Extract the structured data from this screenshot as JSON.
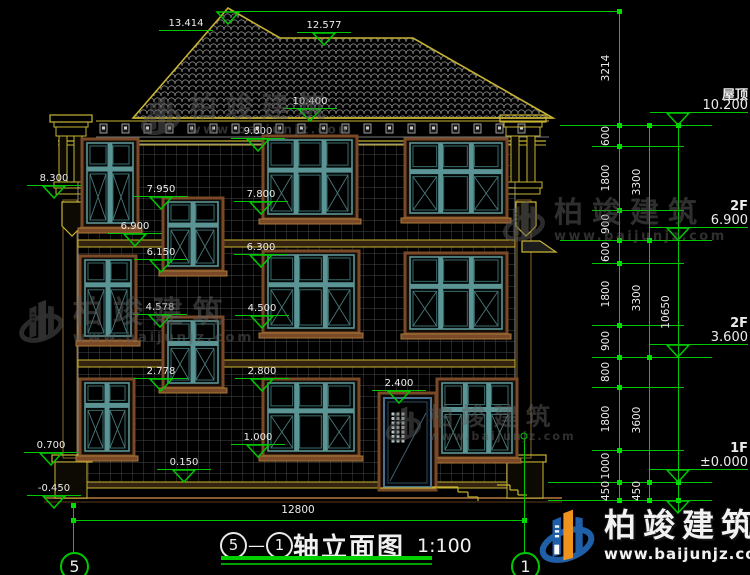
{
  "colors": {
    "annotation_green": "#00c800",
    "text_white": "#ececec",
    "roof_yellow": "#c8b432",
    "trim_brown": "#7a4a28",
    "frame_teal": "#4a8686",
    "wall_grid": "#5f5f5f",
    "brand_blue": "#1e5fa8",
    "brand_orange": "#f0931e",
    "watermark_gray": "#5e5e5e"
  },
  "drawing": {
    "title": {
      "axis_left": "5",
      "separator": "—",
      "axis_right": "1",
      "name": "轴立面图",
      "scale": "1:100"
    },
    "bottom_axes": [
      {
        "label": "5",
        "cx": 73
      },
      {
        "label": "1",
        "cx": 524
      }
    ],
    "overall_dim": {
      "label": "12800",
      "cx": 298,
      "text_y": 504,
      "line_y": 520,
      "x1": 73,
      "x2": 524
    },
    "apex_triangle": {
      "x": 228,
      "y": 11,
      "line_x2": 622
    },
    "elevation_markers": [
      {
        "label": "13.414",
        "cx": 186,
        "y": 31,
        "tri": false
      },
      {
        "label": "12.577",
        "cx": 324,
        "y": 33,
        "tri": true
      },
      {
        "label": "10.400",
        "cx": 310,
        "y": 109,
        "tri": true
      },
      {
        "label": "9.600",
        "cx": 258,
        "y": 139,
        "tri": true
      },
      {
        "label": "8.300",
        "cx": 54,
        "y": 186,
        "tri": true
      },
      {
        "label": "7.950",
        "cx": 161,
        "y": 197,
        "tri": true
      },
      {
        "label": "7.800",
        "cx": 261,
        "y": 202,
        "tri": true
      },
      {
        "label": "6.900",
        "cx": 135,
        "y": 234,
        "tri": true
      },
      {
        "label": "6.300",
        "cx": 261,
        "y": 255,
        "tri": true
      },
      {
        "label": "6.150",
        "cx": 161,
        "y": 260,
        "tri": true
      },
      {
        "label": "4.578",
        "cx": 160,
        "y": 315,
        "tri": true
      },
      {
        "label": "4.500",
        "cx": 262,
        "y": 316,
        "tri": true
      },
      {
        "label": "2.778",
        "cx": 161,
        "y": 379,
        "tri": true
      },
      {
        "label": "2.800",
        "cx": 262,
        "y": 379,
        "tri": true
      },
      {
        "label": "2.400",
        "cx": 399,
        "y": 391,
        "tri": true
      },
      {
        "label": "1.000",
        "cx": 258,
        "y": 445,
        "tri": true
      },
      {
        "label": "0.700",
        "cx": 51,
        "y": 453,
        "tri": true
      },
      {
        "label": "0.150",
        "cx": 184,
        "y": 470,
        "tri": true
      },
      {
        "label": "-0.450",
        "cx": 54,
        "y": 496,
        "tri": true
      }
    ],
    "levels": [
      {
        "name": "屋顶",
        "value": "10.200",
        "y": 125,
        "below": false
      },
      {
        "name": "2F",
        "value": "6.900",
        "y": 240,
        "below": false
      },
      {
        "name": "2F",
        "value": "3.600",
        "y": 357,
        "below": false
      },
      {
        "name": "1F",
        "value": "±0.000",
        "y": 482,
        "below": false
      },
      {
        "name": "",
        "value": "",
        "y": 500,
        "below": true
      }
    ],
    "chains": [
      {
        "x": 619,
        "y1": 11,
        "y2": 500,
        "label_x": 606,
        "ticks": [
          11,
          125,
          146,
          210,
          240,
          263,
          325,
          357,
          387,
          450,
          482,
          500
        ],
        "labels": [
          [
            "3214",
            68
          ],
          [
            "600",
            136
          ],
          [
            "1800",
            178
          ],
          [
            "900",
            224
          ],
          [
            "600",
            252
          ],
          [
            "1800",
            294
          ],
          [
            "900",
            341
          ],
          [
            "800",
            372
          ],
          [
            "1800",
            419
          ],
          [
            "1000",
            466
          ],
          [
            "450",
            491
          ]
        ]
      },
      {
        "x": 649,
        "y1": 125,
        "y2": 500,
        "label_x": 637,
        "ticks": [
          125,
          240,
          357,
          482,
          500
        ],
        "labels": [
          [
            "3300",
            182
          ],
          [
            "3300",
            298
          ],
          [
            "3600",
            420
          ],
          [
            "450",
            491
          ]
        ]
      },
      {
        "x": 678,
        "y1": 125,
        "y2": 512,
        "label_x": 666,
        "ticks": [
          125,
          482,
          500
        ],
        "labels": [
          [
            "10650",
            312
          ]
        ]
      }
    ],
    "ext_lines": [
      {
        "y": 11,
        "x1": 233,
        "x2": 622
      },
      {
        "y": 125,
        "x1": 560,
        "x2": 712
      },
      {
        "y": 146,
        "x1": 592,
        "x2": 684
      },
      {
        "y": 210,
        "x1": 592,
        "x2": 684
      },
      {
        "y": 240,
        "x1": 560,
        "x2": 712
      },
      {
        "y": 263,
        "x1": 592,
        "x2": 684
      },
      {
        "y": 325,
        "x1": 592,
        "x2": 684
      },
      {
        "y": 357,
        "x1": 592,
        "x2": 712
      },
      {
        "y": 387,
        "x1": 592,
        "x2": 684
      },
      {
        "y": 450,
        "x1": 592,
        "x2": 684
      },
      {
        "y": 482,
        "x1": 548,
        "x2": 712
      },
      {
        "y": 500,
        "x1": 548,
        "x2": 712
      }
    ]
  },
  "watermark": {
    "text": "柏竣建筑",
    "url": "www.baijunjz.com",
    "instances": [
      {
        "x": 138,
        "y": 90,
        "s": 0.95
      },
      {
        "x": 500,
        "y": 194,
        "s": 1.0
      },
      {
        "x": 16,
        "y": 293,
        "s": 1.05
      },
      {
        "x": 383,
        "y": 401,
        "s": 0.85
      }
    ]
  },
  "brand": {
    "text": "柏竣建筑",
    "url": "www.baijunjz.com"
  }
}
